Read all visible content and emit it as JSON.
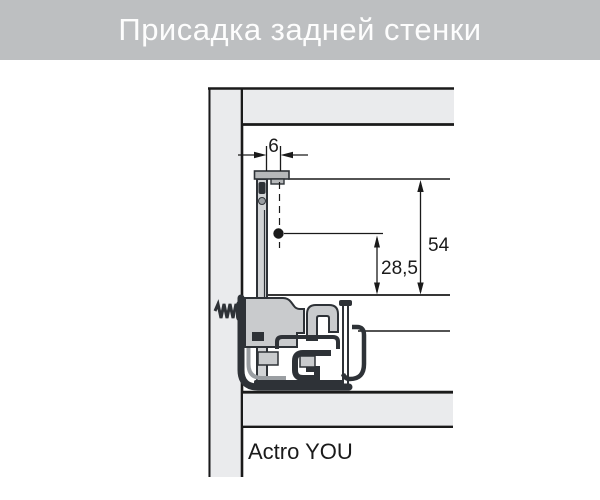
{
  "title_bar": {
    "title": "Присадка задней стенки"
  },
  "diagram": {
    "product_label": "Actro YOU",
    "dimensions": {
      "flange_offset": "6",
      "back_height": "54",
      "hole_center_height": "28,5"
    },
    "colors": {
      "title_bar_bg": "#bdbfc1",
      "title_text": "#ffffff",
      "panel_fill": "#eaebed",
      "outline": "#1a1a1a",
      "mechanism_dark": "#2e3237",
      "mechanism_light": "#c9cbcd",
      "flange_gray": "#b6b8ba"
    }
  }
}
